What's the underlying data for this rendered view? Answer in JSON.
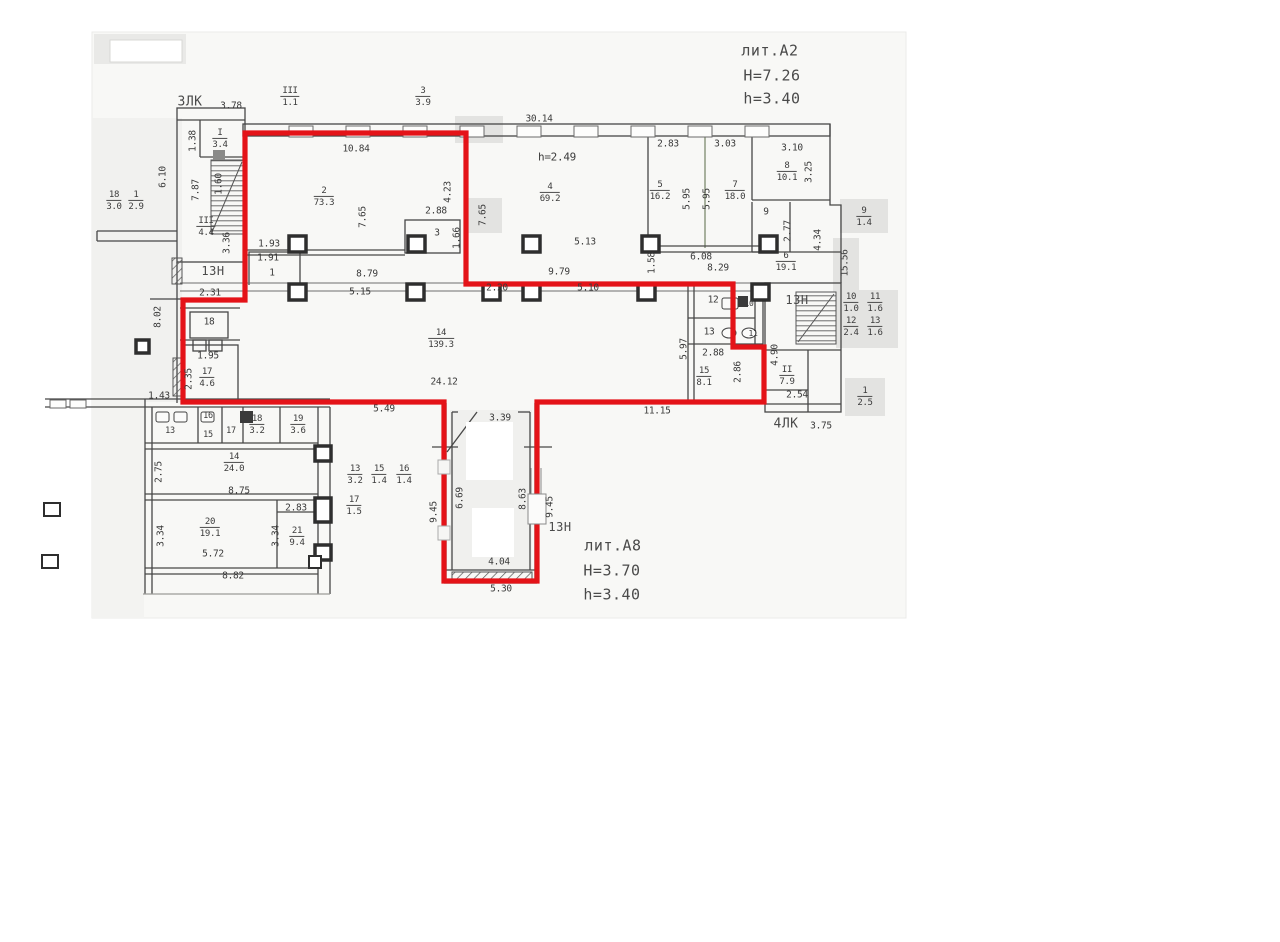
{
  "colors": {
    "outline_red": "#e41318",
    "wall": "#474747",
    "text": "#3b3b3b",
    "gray_box": "#e3e3e1",
    "page": "#f8f8f6"
  },
  "labels": [
    {
      "t": "лит.А2",
      "x": 770,
      "y": 51,
      "fs": 15,
      "n": "liter-a2-label"
    },
    {
      "t": "Н=7.26",
      "x": 772,
      "y": 76,
      "fs": 15,
      "n": "height-a2-label"
    },
    {
      "t": "h=3.40",
      "x": 772,
      "y": 99,
      "fs": 15,
      "n": "ceiling-a2-label"
    },
    {
      "t": "лит.А8",
      "x": 613,
      "y": 546,
      "fs": 15,
      "n": "liter-a8-label"
    },
    {
      "t": "Н=3.70",
      "x": 612,
      "y": 571,
      "fs": 15,
      "n": "height-a8-label"
    },
    {
      "t": "h=3.40",
      "x": 612,
      "y": 595,
      "fs": 15,
      "n": "ceiling-a8-label"
    },
    {
      "t": "3ЛК",
      "x": 190,
      "y": 102,
      "fs": 13,
      "n": "stairwell-3lk-label"
    },
    {
      "t": "3.78",
      "x": 231,
      "y": 106
    },
    {
      "t": "4ЛК",
      "x": 786,
      "y": 424,
      "fs": 13,
      "n": "stairwell-4lk-label"
    },
    {
      "t": "3.75",
      "x": 821,
      "y": 426
    },
    {
      "t": "13Н",
      "x": 213,
      "y": 271,
      "fs": 12,
      "n": "premise-label"
    },
    {
      "t": "13Н",
      "x": 797,
      "y": 300,
      "fs": 12,
      "n": "premise-label"
    },
    {
      "t": "1ЗН",
      "x": 560,
      "y": 527,
      "fs": 12,
      "n": "premise-label"
    },
    {
      "t": "30.14",
      "x": 539,
      "y": 119
    },
    {
      "t": "10.84",
      "x": 356,
      "y": 149
    },
    {
      "t": "h=2.49",
      "x": 557,
      "y": 157,
      "fs": 11
    },
    {
      "t": "2.83",
      "x": 668,
      "y": 144
    },
    {
      "t": "3.03",
      "x": 725,
      "y": 144
    },
    {
      "t": "3.10",
      "x": 792,
      "y": 148
    },
    {
      "t": "2.88",
      "x": 436,
      "y": 211
    },
    {
      "t": "3",
      "x": 437,
      "y": 233
    },
    {
      "t": "5.13",
      "x": 585,
      "y": 242
    },
    {
      "t": "6.08",
      "x": 701,
      "y": 257
    },
    {
      "t": "8.79",
      "x": 367,
      "y": 274
    },
    {
      "t": "5.15",
      "x": 360,
      "y": 292
    },
    {
      "t": "2.20",
      "x": 497,
      "y": 288
    },
    {
      "t": "9.79",
      "x": 559,
      "y": 272
    },
    {
      "t": "5.10",
      "x": 588,
      "y": 288
    },
    {
      "t": "8.29",
      "x": 718,
      "y": 268
    },
    {
      "t": "1.93",
      "x": 269,
      "y": 244
    },
    {
      "t": "1.91",
      "x": 268,
      "y": 258
    },
    {
      "t": "1",
      "x": 272,
      "y": 273
    },
    {
      "t": "2.31",
      "x": 210,
      "y": 293
    },
    {
      "t": "18",
      "x": 209,
      "y": 322
    },
    {
      "t": "1.95",
      "x": 208,
      "y": 356
    },
    {
      "t": "1.43",
      "x": 159,
      "y": 396
    },
    {
      "t": "24.12",
      "x": 444,
      "y": 382
    },
    {
      "t": "5.49",
      "x": 384,
      "y": 409
    },
    {
      "t": "11.15",
      "x": 657,
      "y": 411
    },
    {
      "t": "3.39",
      "x": 500,
      "y": 418
    },
    {
      "t": "2.88",
      "x": 713,
      "y": 353
    },
    {
      "t": "2.54",
      "x": 797,
      "y": 395
    },
    {
      "t": "12",
      "x": 713,
      "y": 300
    },
    {
      "t": "13",
      "x": 709,
      "y": 332
    },
    {
      "t": "10",
      "x": 749,
      "y": 304,
      "fs": 8
    },
    {
      "t": "11",
      "x": 753,
      "y": 334,
      "fs": 8
    },
    {
      "t": "9",
      "x": 766,
      "y": 212
    },
    {
      "t": "4.04",
      "x": 499,
      "y": 562
    },
    {
      "t": "5.30",
      "x": 501,
      "y": 589
    },
    {
      "t": "8.75",
      "x": 239,
      "y": 491
    },
    {
      "t": "2.83",
      "x": 296,
      "y": 508
    },
    {
      "t": "5.72",
      "x": 213,
      "y": 554
    },
    {
      "t": "8.82",
      "x": 233,
      "y": 576
    },
    {
      "t": "13",
      "x": 170,
      "y": 431,
      "fs": 8.5
    },
    {
      "t": "16",
      "x": 208,
      "y": 416,
      "fs": 8.5
    },
    {
      "t": "15",
      "x": 208,
      "y": 435,
      "fs": 8.5
    },
    {
      "t": "17",
      "x": 231,
      "y": 431,
      "fs": 8.5
    },
    {
      "t": "6.10",
      "x": 163,
      "y": 177,
      "r": 1
    },
    {
      "t": "1.38",
      "x": 193,
      "y": 141,
      "r": 1
    },
    {
      "t": "7.87",
      "x": 196,
      "y": 190,
      "r": 1
    },
    {
      "t": "1.60",
      "x": 219,
      "y": 184,
      "r": 1
    },
    {
      "t": "3.36",
      "x": 227,
      "y": 243,
      "r": 1
    },
    {
      "t": "8.02",
      "x": 158,
      "y": 317,
      "r": 1
    },
    {
      "t": "2.35",
      "x": 189,
      "y": 379,
      "r": 1
    },
    {
      "t": "7.65",
      "x": 363,
      "y": 217,
      "r": 1
    },
    {
      "t": "4.23",
      "x": 448,
      "y": 192,
      "r": 1
    },
    {
      "t": "1.66",
      "x": 457,
      "y": 238,
      "r": 1
    },
    {
      "t": "7.65",
      "x": 483,
      "y": 215,
      "r": 1
    },
    {
      "t": "5.95",
      "x": 687,
      "y": 199,
      "r": 1
    },
    {
      "t": "5.95",
      "x": 707,
      "y": 199,
      "r": 1
    },
    {
      "t": "3.25",
      "x": 809,
      "y": 172,
      "r": 1
    },
    {
      "t": "2.77",
      "x": 788,
      "y": 231,
      "r": 1
    },
    {
      "t": "4.34",
      "x": 818,
      "y": 240,
      "r": 1
    },
    {
      "t": "1.58",
      "x": 652,
      "y": 263,
      "r": 1
    },
    {
      "t": "15.56",
      "x": 845,
      "y": 263,
      "r": 1
    },
    {
      "t": "5.97",
      "x": 684,
      "y": 349,
      "r": 1
    },
    {
      "t": "2.86",
      "x": 738,
      "y": 372,
      "r": 1
    },
    {
      "t": "4.90",
      "x": 775,
      "y": 355,
      "r": 1
    },
    {
      "t": "2.75",
      "x": 159,
      "y": 472,
      "r": 1
    },
    {
      "t": "3.34",
      "x": 161,
      "y": 536,
      "r": 1
    },
    {
      "t": "3.34",
      "x": 276,
      "y": 536,
      "r": 1
    },
    {
      "t": "9.45",
      "x": 434,
      "y": 512,
      "r": 1
    },
    {
      "t": "6.69",
      "x": 460,
      "y": 498,
      "r": 1
    },
    {
      "t": "8.63",
      "x": 523,
      "y": 499,
      "r": 1
    },
    {
      "t": "9.45",
      "x": 550,
      "y": 507,
      "r": 1
    }
  ],
  "fractions": [
    {
      "a": "III",
      "b": "1.1",
      "x": 290,
      "y": 97
    },
    {
      "a": "3",
      "b": "3.9",
      "x": 423,
      "y": 97
    },
    {
      "a": "I",
      "b": "3.4",
      "x": 220,
      "y": 139
    },
    {
      "a": "18",
      "b": "3.0",
      "x": 114,
      "y": 201
    },
    {
      "a": "1",
      "b": "2.9",
      "x": 136,
      "y": 201
    },
    {
      "a": "2",
      "b": "73.3",
      "x": 324,
      "y": 197
    },
    {
      "a": "4",
      "b": "69.2",
      "x": 550,
      "y": 193
    },
    {
      "a": "5",
      "b": "16.2",
      "x": 660,
      "y": 191
    },
    {
      "a": "7",
      "b": "18.0",
      "x": 735,
      "y": 191
    },
    {
      "a": "8",
      "b": "10.1",
      "x": 787,
      "y": 172
    },
    {
      "a": "6",
      "b": "19.1",
      "x": 786,
      "y": 262
    },
    {
      "a": "III",
      "b": "4.4",
      "x": 206,
      "y": 227
    },
    {
      "a": "14",
      "b": "139.3",
      "x": 441,
      "y": 339
    },
    {
      "a": "15",
      "b": "8.1",
      "x": 704,
      "y": 377
    },
    {
      "a": "II",
      "b": "7.9",
      "x": 787,
      "y": 376
    },
    {
      "a": "17",
      "b": "4.6",
      "x": 207,
      "y": 378
    },
    {
      "a": "18",
      "b": "3.2",
      "x": 257,
      "y": 425
    },
    {
      "a": "19",
      "b": "3.6",
      "x": 298,
      "y": 425
    },
    {
      "a": "14",
      "b": "24.0",
      "x": 234,
      "y": 463
    },
    {
      "a": "20",
      "b": "19.1",
      "x": 210,
      "y": 528
    },
    {
      "a": "21",
      "b": "9.4",
      "x": 297,
      "y": 537
    },
    {
      "a": "13",
      "b": "3.2",
      "x": 355,
      "y": 475
    },
    {
      "a": "15",
      "b": "1.4",
      "x": 379,
      "y": 475
    },
    {
      "a": "16",
      "b": "1.4",
      "x": 404,
      "y": 475
    },
    {
      "a": "17",
      "b": "1.5",
      "x": 354,
      "y": 506
    },
    {
      "a": "9",
      "b": "1.4",
      "x": 864,
      "y": 217
    },
    {
      "a": "10",
      "b": "1.0",
      "x": 851,
      "y": 303
    },
    {
      "a": "11",
      "b": "1.6",
      "x": 875,
      "y": 303
    },
    {
      "a": "12",
      "b": "2.4",
      "x": 851,
      "y": 327
    },
    {
      "a": "13",
      "b": "1.6",
      "x": 875,
      "y": 327
    },
    {
      "a": "1",
      "b": "2.5",
      "x": 865,
      "y": 397
    }
  ]
}
